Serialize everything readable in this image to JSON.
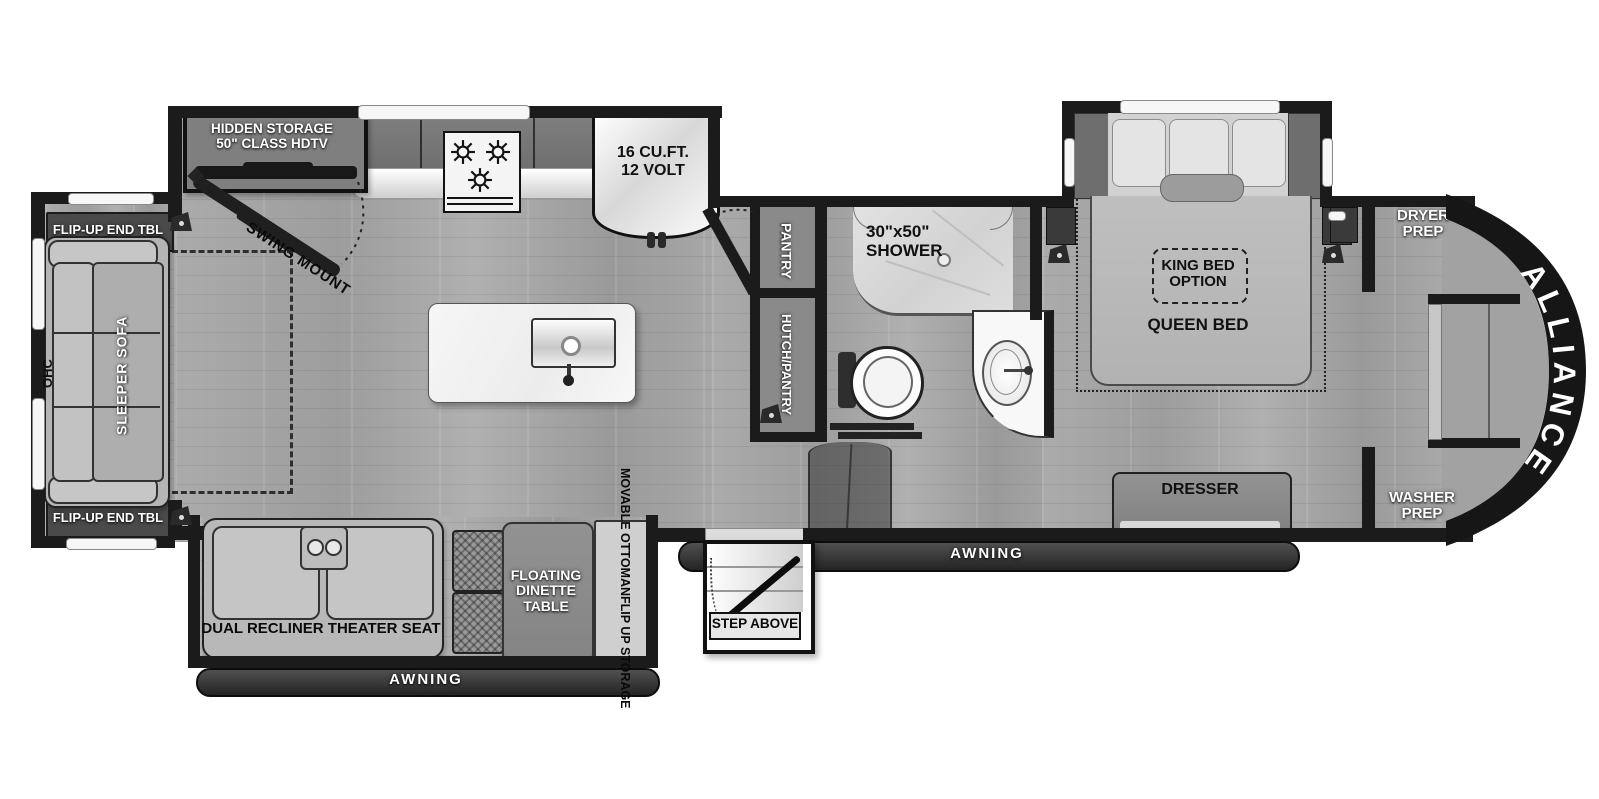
{
  "plan": {
    "brand": "ALLIANCE",
    "living": {
      "flip_up_end_tbl_top": "FLIP-UP END TBL",
      "flip_up_end_tbl_bottom": "FLIP-UP END TBL",
      "ohc": "OHC",
      "sleeper_sofa": "SLEEPER SOFA",
      "hidden_storage_l1": "HIDDEN STORAGE",
      "hidden_storage_l2": "50\" CLASS HDTV",
      "swing_mount": "SWING MOUNT"
    },
    "kitchen": {
      "fridge_l1": "16 CU.FT.",
      "fridge_l2": "12 VOLT",
      "pantry": "PANTRY",
      "hutch_pantry": "HUTCH/PANTRY"
    },
    "bath": {
      "shower_l1": "30\"x50\"",
      "shower_l2": "SHOWER"
    },
    "bedroom": {
      "king_l1": "KING BED",
      "king_l2": "OPTION",
      "queen": "QUEEN BED",
      "dresser": "DRESSER"
    },
    "front": {
      "dryer_l1": "DRYER",
      "dryer_l2": "PREP",
      "washer_l1": "WASHER",
      "washer_l2": "PREP"
    },
    "slide_bottom": {
      "theater": "DUAL RECLINER THEATER SEAT",
      "dinette_l1": "FLOATING",
      "dinette_l2": "DINETTE",
      "dinette_l3": "TABLE",
      "ottoman_l1": "MOVABLE OTTOMAN",
      "ottoman_l2": "FLIP UP STORAGE"
    },
    "exterior": {
      "awning_left": "AWNING",
      "awning_right": "AWNING",
      "step_above": "STEP ABOVE"
    },
    "colors": {
      "wall": "#1b1b1b",
      "floor": "#a6a6a6",
      "cap": "#161616",
      "label_dark_band": "#4a4a4a"
    }
  }
}
